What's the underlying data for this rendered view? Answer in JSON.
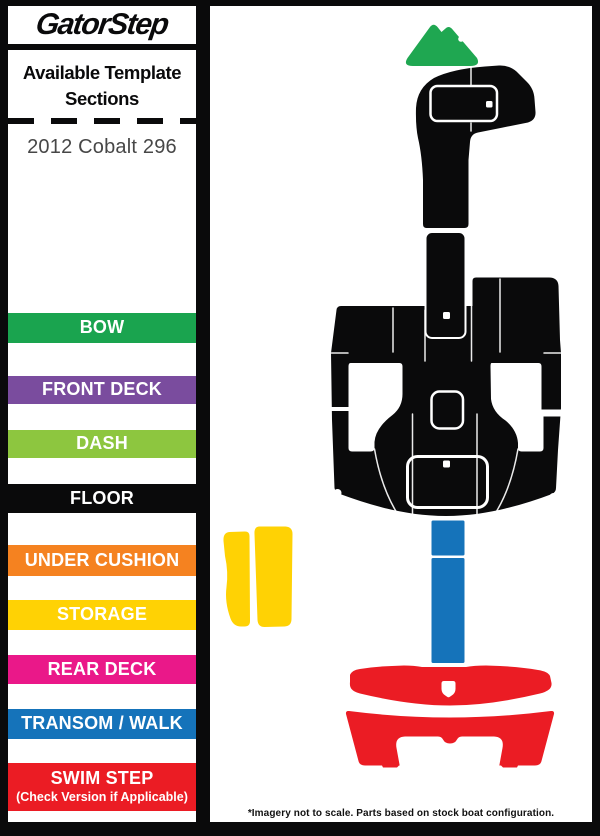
{
  "brand": {
    "logo_text": "GatorStep"
  },
  "sidebar": {
    "title_line1": "Available Template",
    "title_line2": "Sections",
    "model": "2012 Cobalt 296",
    "sections": [
      {
        "label": "BOW",
        "color": "#1aa44f"
      },
      {
        "label": "FRONT DECK",
        "color": "#7a4c9e"
      },
      {
        "label": "DASH",
        "color": "#8dc63f"
      },
      {
        "label": "FLOOR",
        "color": "#0a0a0b"
      },
      {
        "label": "UNDER CUSHION",
        "color": "#f58220"
      },
      {
        "label": "STORAGE",
        "color": "#ffd204"
      },
      {
        "label": "REAR DECK",
        "color": "#ea1889"
      },
      {
        "label": "TRANSOM / WALK",
        "color": "#1573ba"
      },
      {
        "label": "SWIM STEP",
        "sublabel": "(Check Version if Applicable)",
        "color": "#eb1c24"
      }
    ]
  },
  "diagram": {
    "colors": {
      "bow": "#1fa751",
      "floor": "#0a0a0b",
      "storage": "#ffd204",
      "transom": "#1573ba",
      "swim": "#eb1c24"
    }
  },
  "footer": {
    "note": "*Imagery not to scale. Parts based on stock boat configuration."
  }
}
